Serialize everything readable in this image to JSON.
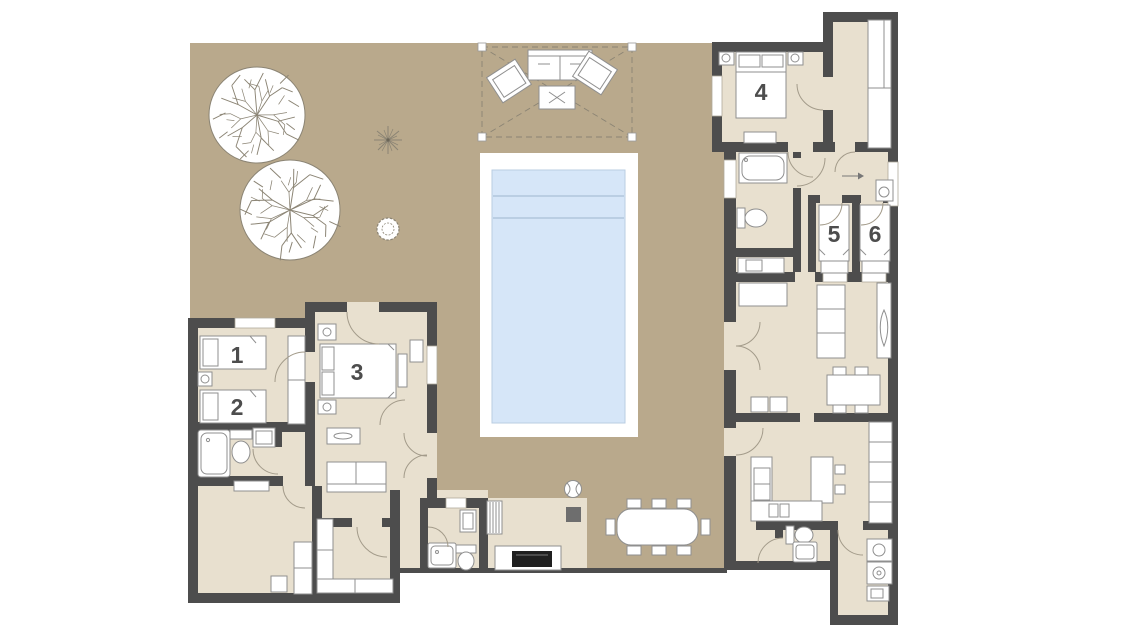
{
  "room_labels": {
    "r1": "1",
    "r2": "2",
    "r3": "3",
    "r4": "4",
    "r5": "5",
    "r6": "6"
  },
  "colors": {
    "wall": "#4d4d4d",
    "courtyard": "#b9a98c",
    "floor": "#e8e0cf",
    "deck": "#ffffff",
    "pool_water": "#d6e6f8",
    "pool_line": "#a9c0d6",
    "furniture_stroke": "#8f8f8f",
    "door_stroke": "#a39b8a",
    "foliage_stroke": "#8b8474",
    "label": "#4d4d4d",
    "grill": "#1f1f1f",
    "dark_table": "#6e6e6e"
  },
  "fixtures": [
    "tree-icon",
    "agave-icon",
    "shrub-icon",
    "sphere-decor-icon",
    "pool-icon",
    "pergola-icon",
    "outdoor-sofa-icon",
    "outdoor-armchair-icon",
    "outdoor-coffee-table-icon",
    "outdoor-dining-table-icon",
    "bbq-grill-icon",
    "double-bed-icon",
    "single-bed-icon",
    "nightstand-lamp-icon",
    "bench-icon",
    "wardrobe-icon",
    "sofa-icon",
    "console-plant-icon",
    "dining-table-icon",
    "kitchen-island-icon",
    "stove-icon",
    "kitchen-sink-icon",
    "tall-cabinet-icon",
    "toilet-icon",
    "shower-icon",
    "bathtub-icon",
    "washbasin-icon",
    "washer-icon",
    "dryer-icon",
    "entrance-arrow-icon"
  ]
}
